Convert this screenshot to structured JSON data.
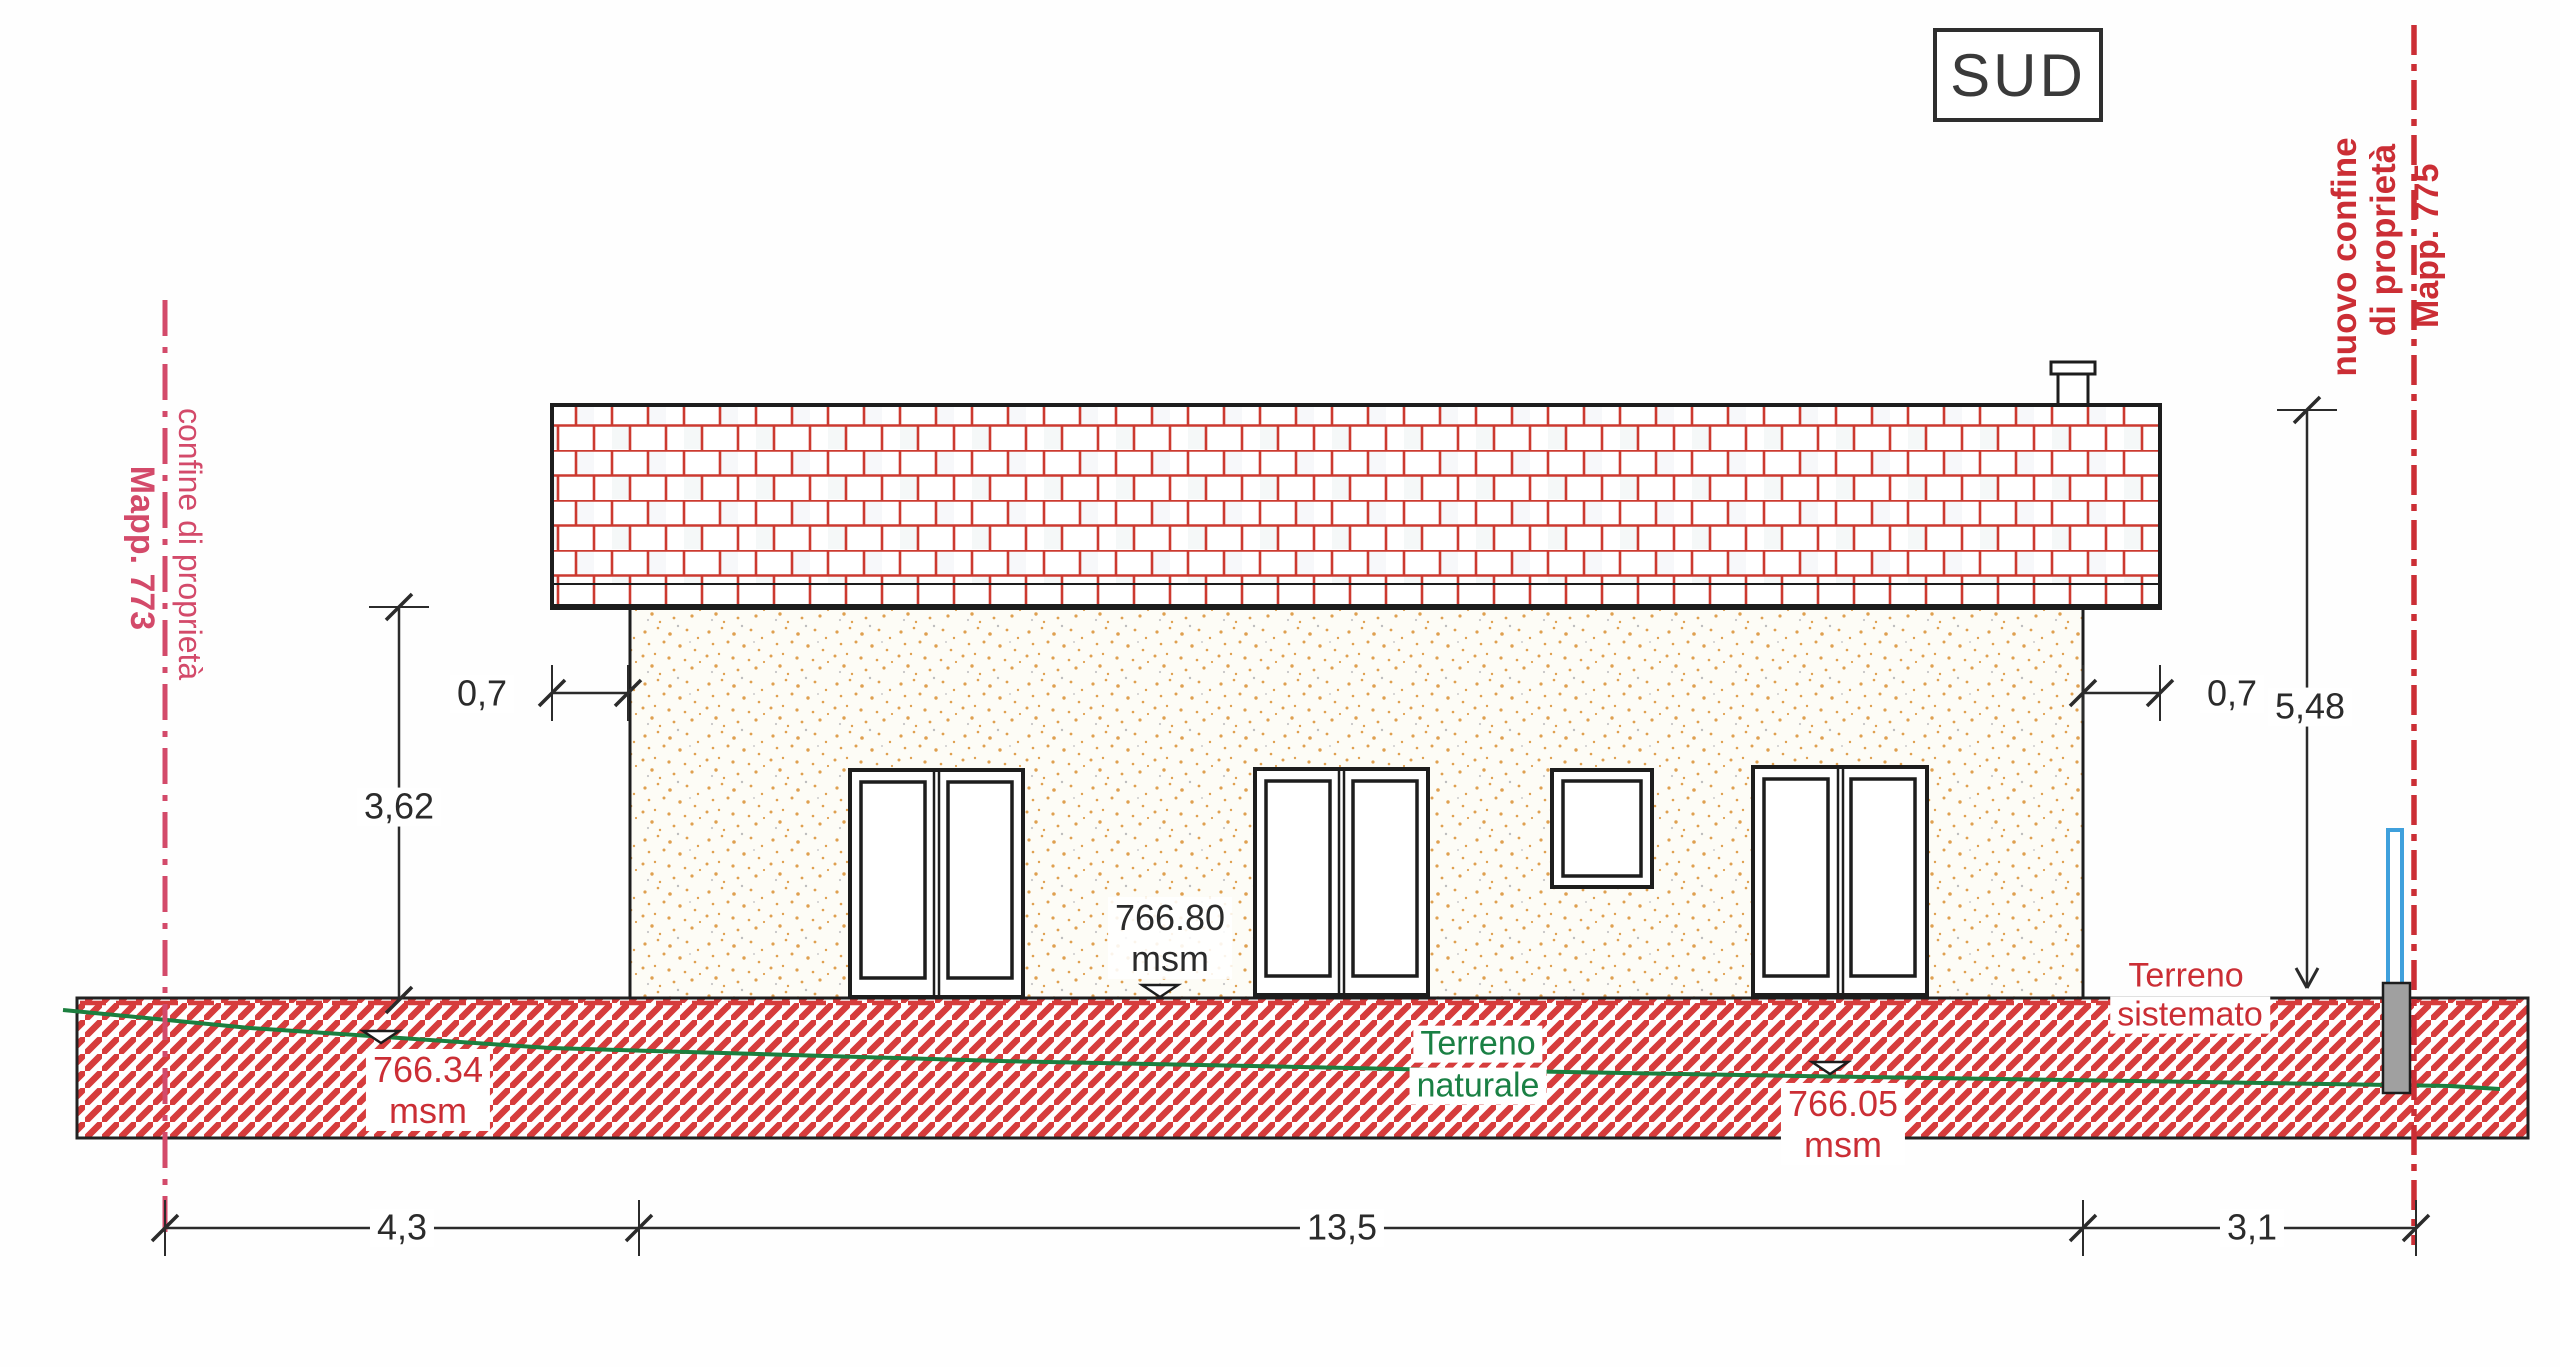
{
  "drawing": {
    "title": "SUD",
    "boundary_left": {
      "label": "confine di proprietà",
      "parcel": "Mapp. 773"
    },
    "boundary_right": {
      "label_line1": "nuovo confine",
      "label_line2": "di proprietà",
      "parcel": "Mapp. 775"
    },
    "dimensions": {
      "roof_overhang_left": "0,7",
      "roof_overhang_right": "0,7",
      "eaves_height": "3,62",
      "ridge_height": "5,48",
      "setback_left": "4,3",
      "building_width": "13,5",
      "setback_right": "3,1"
    },
    "levels": {
      "floor": {
        "value": "766.80",
        "unit": "msm"
      },
      "terrain_left": {
        "value": "766.34",
        "unit": "msm"
      },
      "terrain_right": {
        "value": "766.05",
        "unit": "msm"
      }
    },
    "terrain": {
      "natural": {
        "line1": "Terreno",
        "line2": "naturale"
      },
      "arranged": {
        "line1": "Terreno",
        "line2": "sistemato"
      }
    },
    "colors": {
      "boundary_left": "#d34a6a",
      "boundary_right": "#cb2e35",
      "brick_joint": "#cc3a30",
      "ground_hatch": "#d63c3c",
      "terrain_natural_line": "#1c7f3f",
      "terrain_text_green": "#1a8044",
      "level_text_red": "#cb2e35",
      "marker_blue": "#3fa0dc",
      "post_gray": "#a0a0a0",
      "wall_stipple": "#dfa050"
    }
  }
}
